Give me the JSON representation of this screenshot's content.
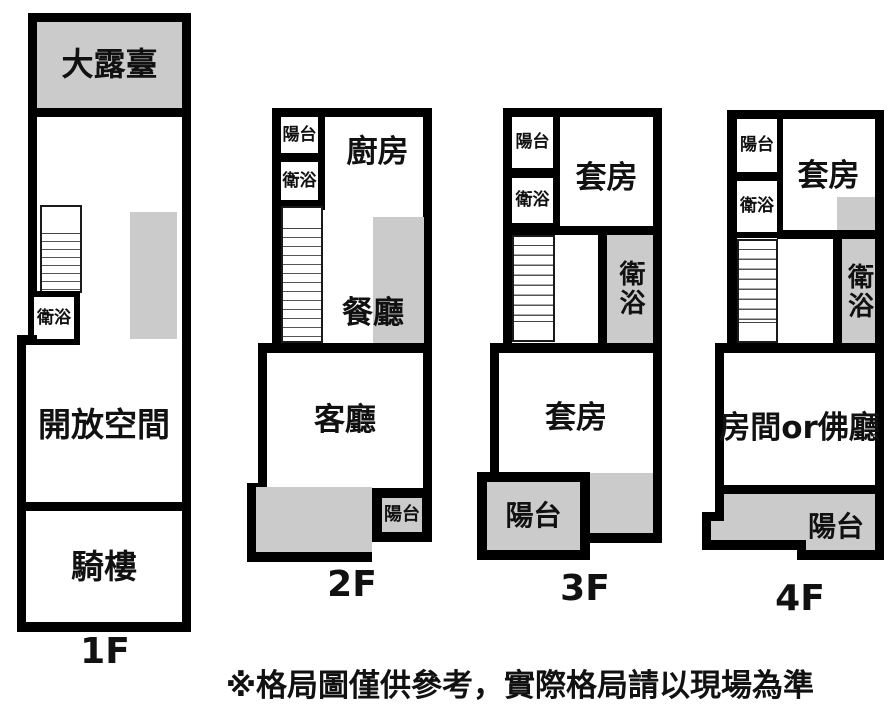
{
  "floors": [
    {
      "label": "1F",
      "rooms": {
        "terrace": "大露臺",
        "bath": "衛浴",
        "open_space": "開放空間",
        "arcade": "騎樓"
      }
    },
    {
      "label": "2F",
      "rooms": {
        "balcony_top": "陽台",
        "bath_top": "衛浴",
        "kitchen": "廚房",
        "dining": "餐廳",
        "living": "客廳",
        "balcony": "陽台"
      }
    },
    {
      "label": "3F",
      "rooms": {
        "balcony_top": "陽台",
        "bath_top": "衛浴",
        "suite_upper": "套房",
        "bath_mid": "衛浴",
        "suite": "套房",
        "balcony": "陽台"
      }
    },
    {
      "label": "4F",
      "rooms": {
        "balcony_top": "陽台",
        "bath_top": "衛浴",
        "suite_upper": "套房",
        "bath_mid": "衛浴",
        "room_or_hall": "房間or佛廳",
        "balcony": "陽台"
      }
    }
  ],
  "disclaimer": "※格局圖僅供參考，實際格局請以現場為準",
  "colors": {
    "wall": "#000000",
    "shaded": "#cbcbcb",
    "background": "#ffffff"
  }
}
